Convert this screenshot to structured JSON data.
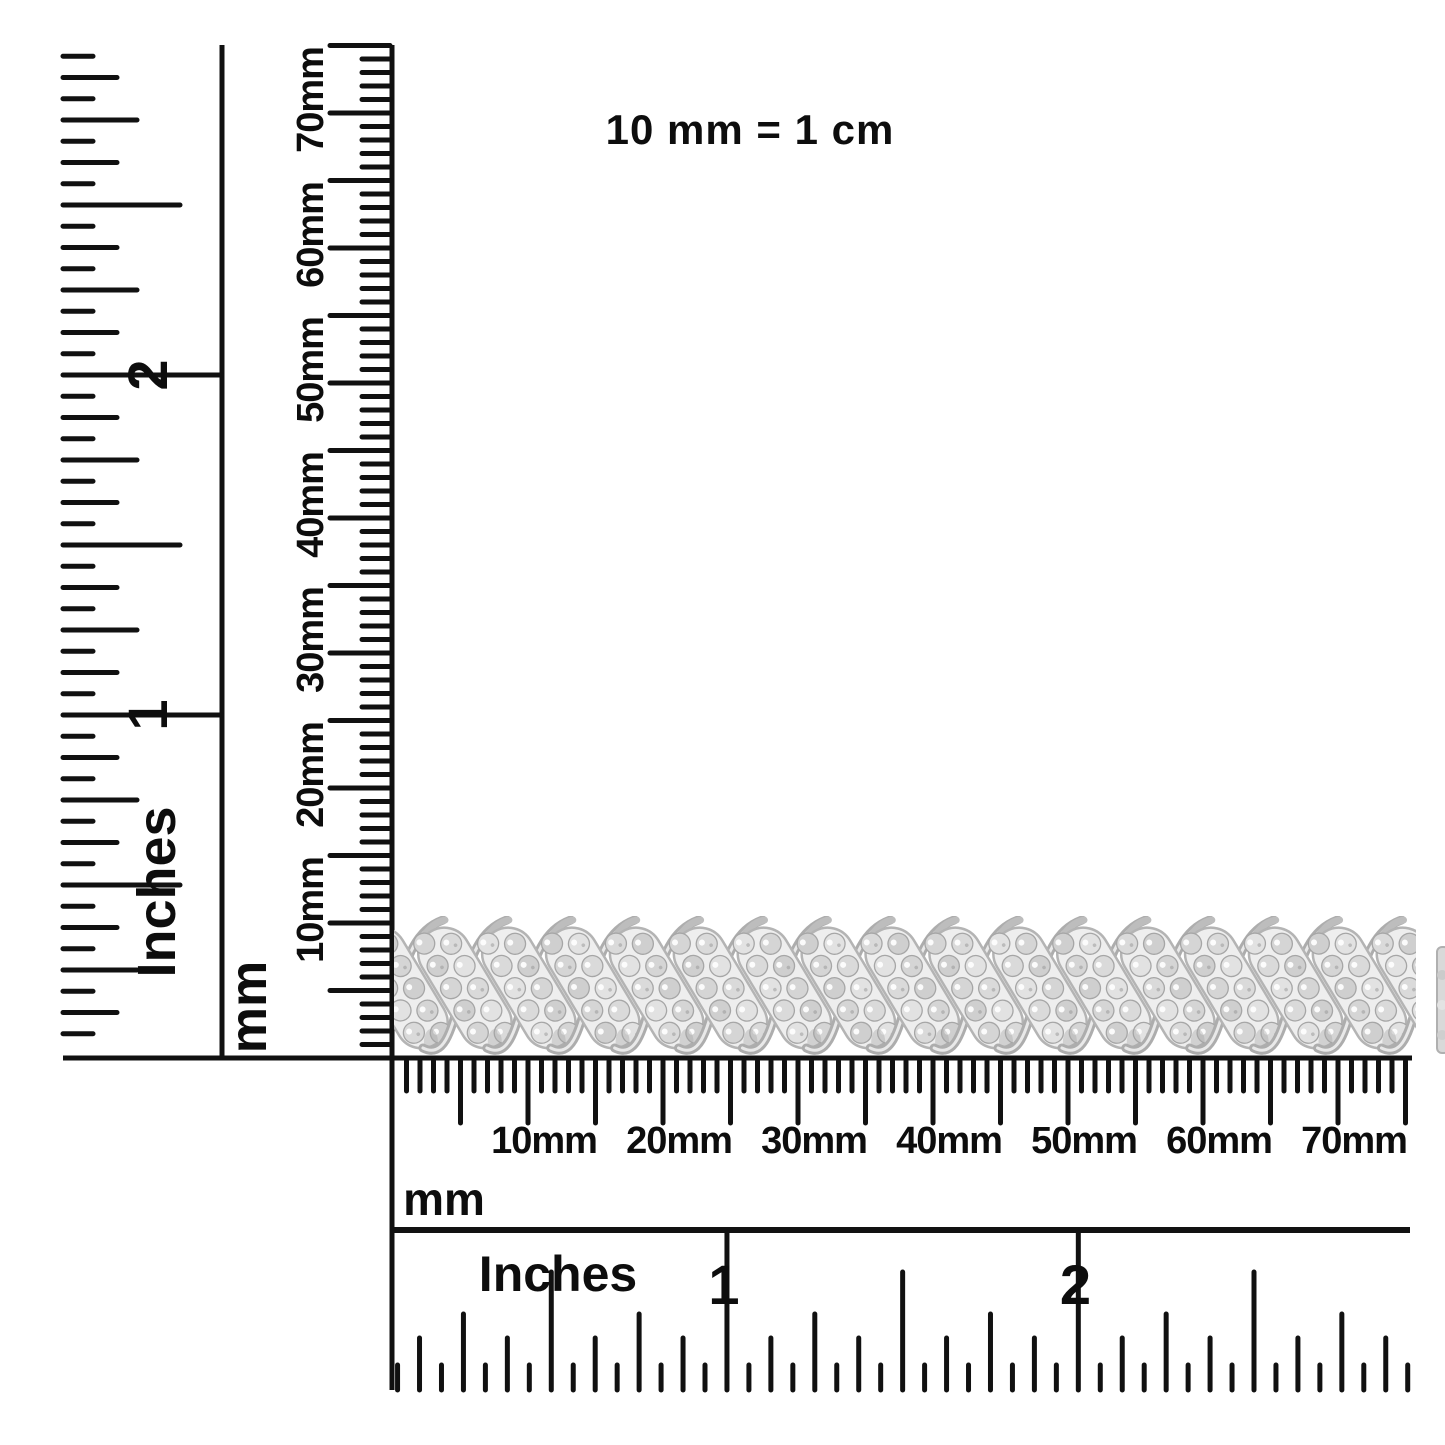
{
  "scale_note": "10 mm = 1 cm",
  "left_ruler": {
    "unit_label": "Inches",
    "numbers": [
      "1",
      "2"
    ],
    "max_sixteenths": 47
  },
  "vertical_mm_ruler": {
    "unit_label": "mm",
    "tick_labels": [
      "10mm",
      "20mm",
      "30mm",
      "40mm",
      "50mm",
      "60mm",
      "70mm"
    ],
    "max_mm": 75
  },
  "horizontal_mm_ruler": {
    "unit_label": "mm",
    "tick_labels": [
      "10mm",
      "20mm",
      "30mm",
      "40mm",
      "50mm",
      "60mm",
      "70mm"
    ],
    "max_mm": 75
  },
  "bottom_ruler": {
    "unit_label": "Inches",
    "numbers": [
      "1",
      "2"
    ],
    "max_sixteenths": 47
  },
  "subject": {
    "description": "pave diamond S-link bracelet photographed between rulers",
    "link_count": 17,
    "metal_color": "#b4b4b4",
    "metal_light": "#e9e9e9",
    "cluster_fill": "#eeeeee",
    "diamond_colors": [
      "#dadada",
      "#cfcfcf",
      "#e2e2e2",
      "#d5d5d5"
    ],
    "glint_color": "#ffffff",
    "shadow_color": "#a5a5a5"
  },
  "colors": {
    "ink": "#111111",
    "background": "#ffffff"
  }
}
